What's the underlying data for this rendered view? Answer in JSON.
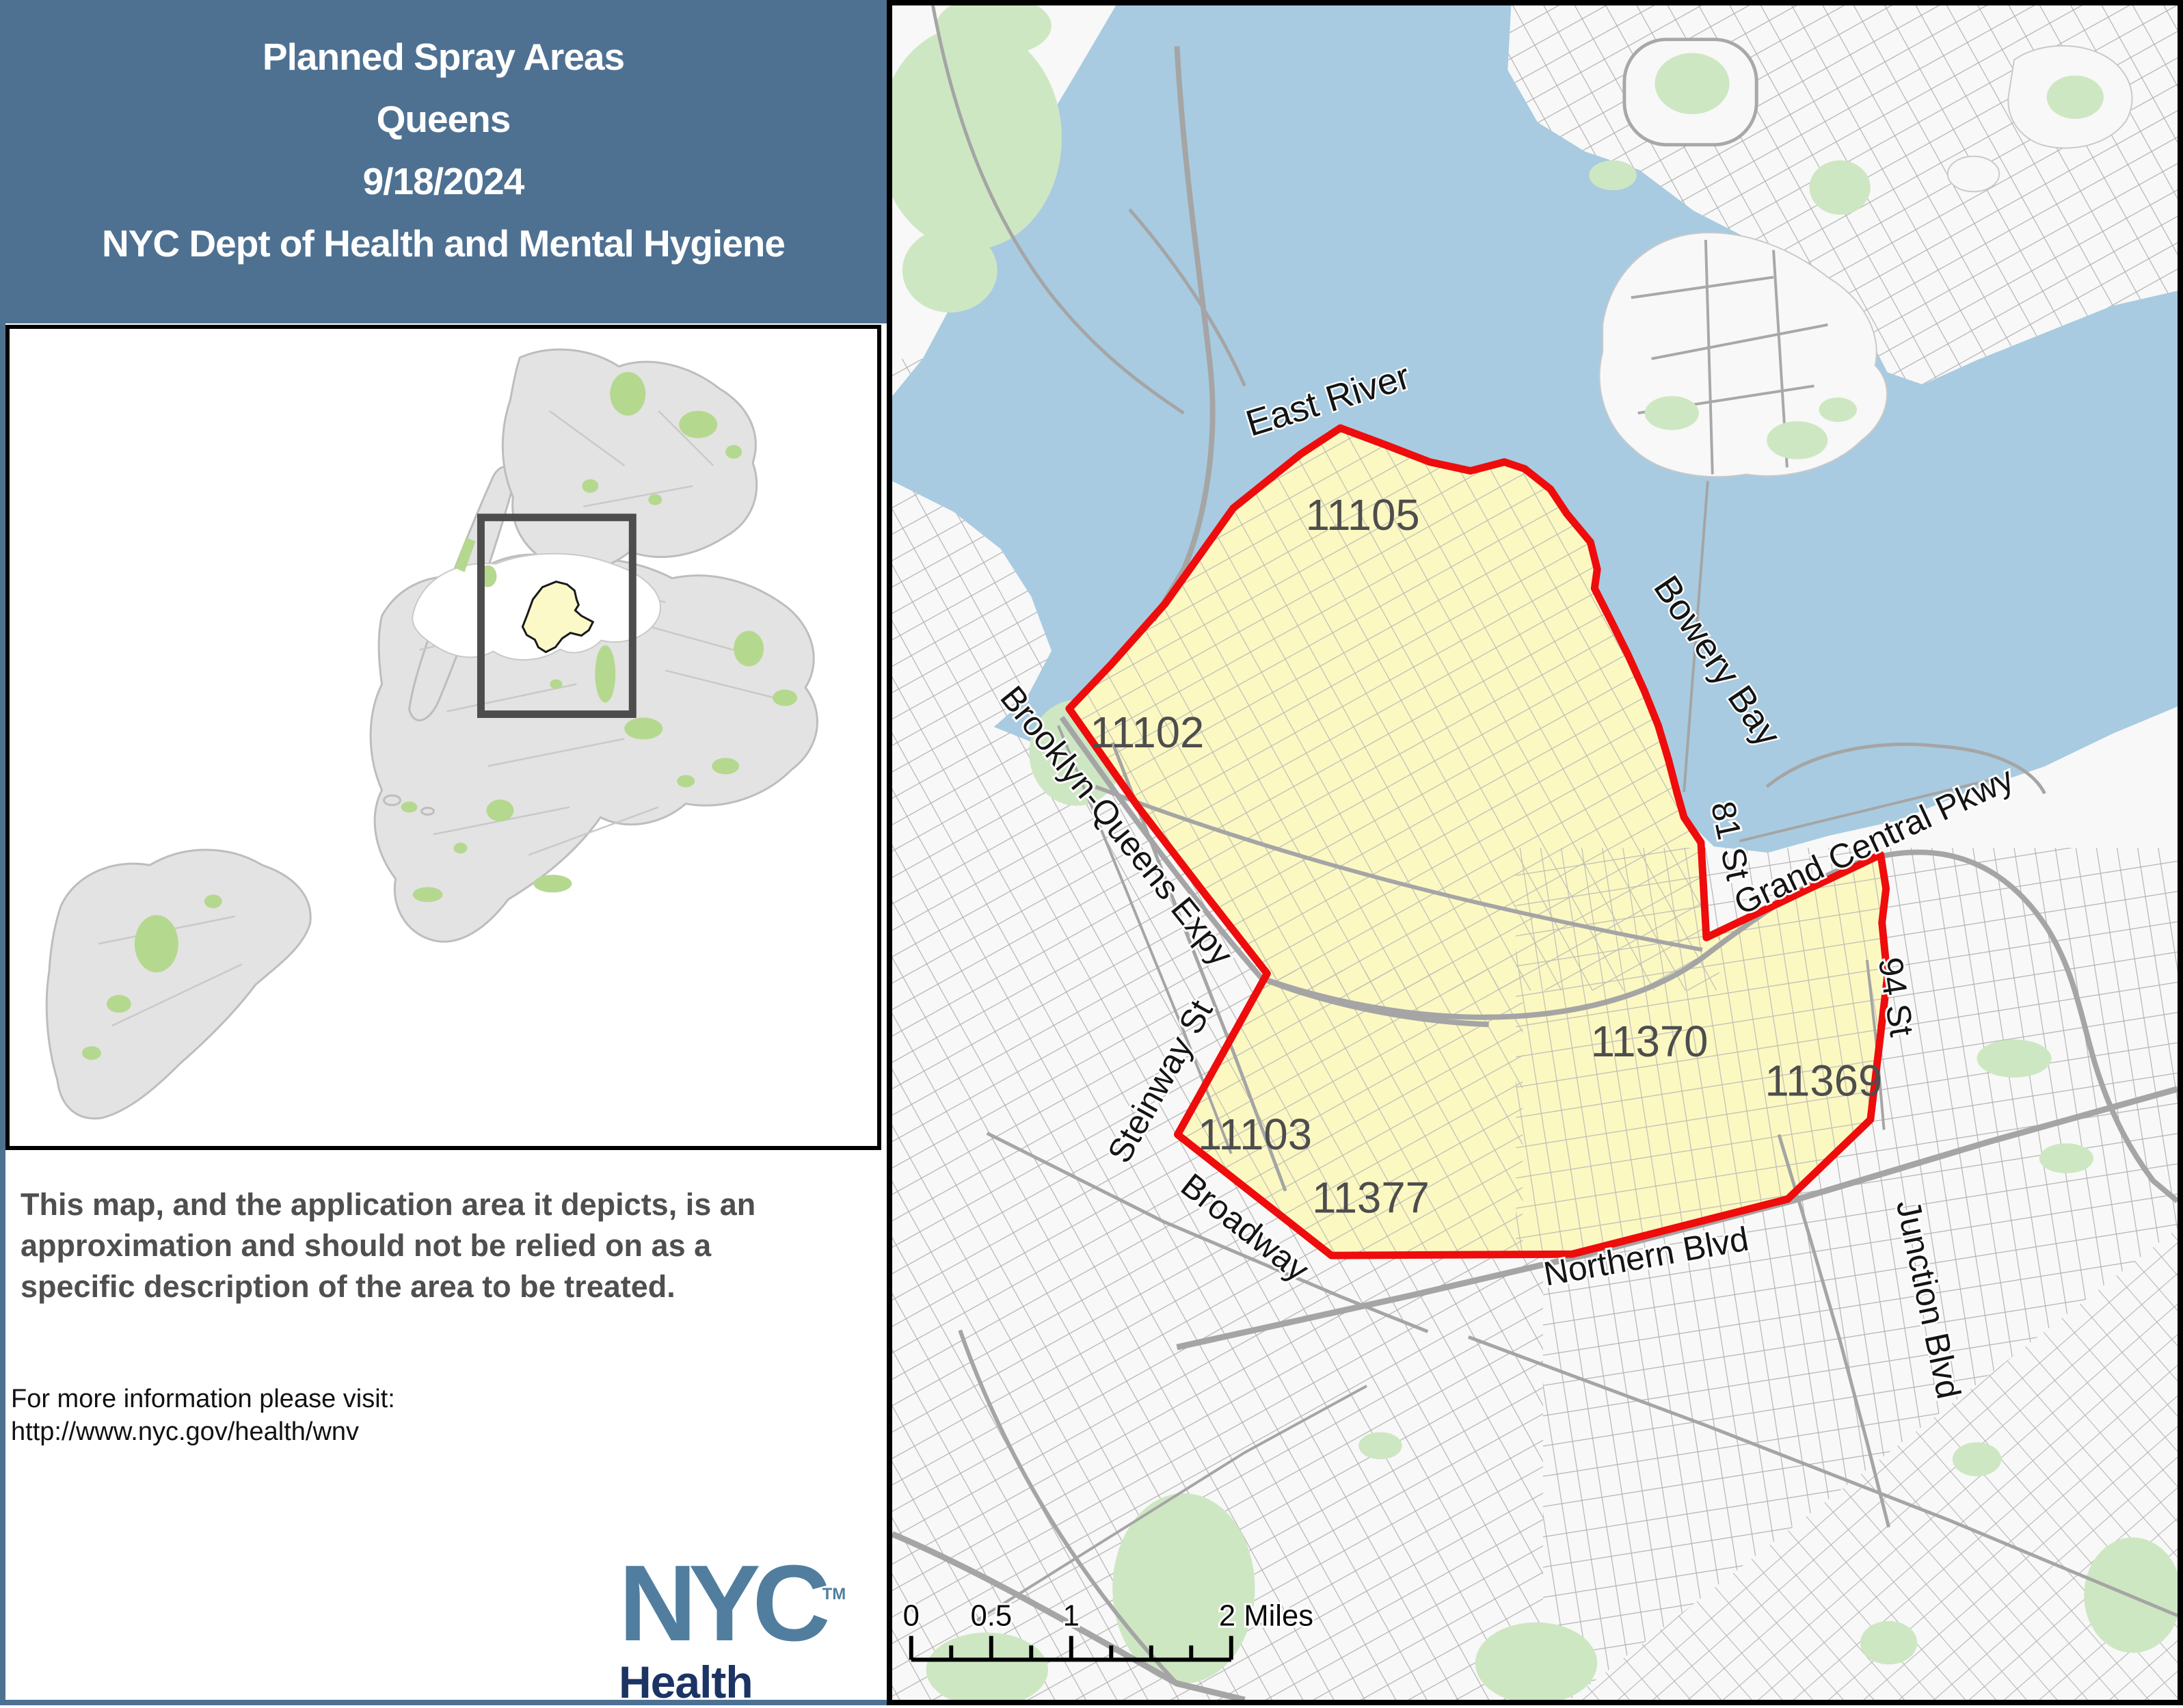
{
  "header": {
    "lines": [
      "Planned Spray Areas",
      "Queens",
      "9/18/2024",
      "NYC Dept of Health and Mental Hygiene"
    ],
    "bg_color": "#4e7192"
  },
  "disclaimer": {
    "text": "This map, and the application area it depicts, is an approximation and should not be relied on as a specific description of the area to be treated."
  },
  "info": {
    "line1": "For more information please visit:",
    "line2": "http://www.nyc.gov/health/wnv"
  },
  "logo": {
    "nyc": "NYC",
    "tm": "TM",
    "health": "Health"
  },
  "map": {
    "water_labels": [
      {
        "label": "East River"
      },
      {
        "label": "Bowery Bay"
      }
    ],
    "zip_labels": [
      {
        "label": "11105"
      },
      {
        "label": "11102"
      },
      {
        "label": "11103"
      },
      {
        "label": "11377"
      },
      {
        "label": "11370"
      },
      {
        "label": "11369"
      }
    ],
    "street_labels": [
      {
        "label": "Brooklyn-Queens Expy"
      },
      {
        "label": "Steinway St"
      },
      {
        "label": "Broadway"
      },
      {
        "label": "Grand Central Pkwy"
      },
      {
        "label": "81 St"
      },
      {
        "label": "94 St"
      },
      {
        "label": "Junction Blvd"
      },
      {
        "label": "Northern Blvd"
      }
    ],
    "scalebar": {
      "labels": [
        "0",
        "0.5",
        "1",
        "2 Miles"
      ]
    },
    "colors": {
      "water": "#a8cbe1",
      "land": "#f8f8f8",
      "park": "#cee7c3",
      "spray_area_fill": "#fbf8c2",
      "spray_area_border": "#ee0c0c",
      "street": "#b0b0b0"
    }
  }
}
